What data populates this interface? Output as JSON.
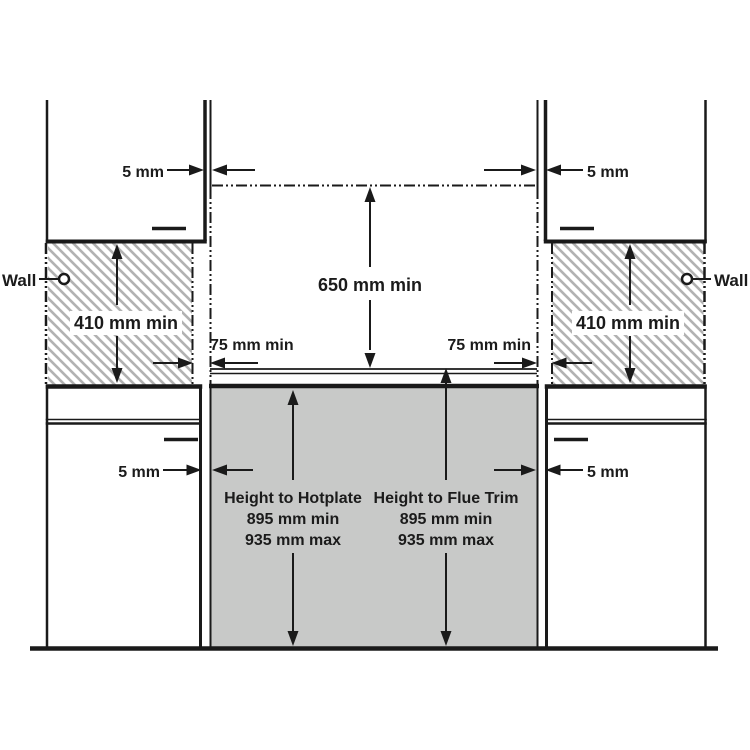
{
  "labels": {
    "wall_left": "Wall",
    "wall_right": "Wall",
    "gap_top_left": "5 mm",
    "gap_top_right": "5 mm",
    "gap_bottom_left": "5 mm",
    "gap_bottom_right": "5 mm",
    "clearance_center_vertical": "650 mm min",
    "clearance_wall_left": "410 mm min",
    "clearance_wall_right": "410 mm min",
    "clearance_hob_left": "75 mm min",
    "clearance_hob_right": "75 mm min",
    "height_to_hotplate": {
      "title": "Height to Hotplate",
      "min": "895 mm min",
      "max": "935 mm max"
    },
    "height_to_flue_trim": {
      "title": "Height to Flue Trim",
      "min": "895 mm min",
      "max": "935 mm max"
    }
  },
  "colors": {
    "line": "#1a1a1a",
    "cooker_fill": "#c8c9c8",
    "hatch_stroke": "#b2b2b2",
    "background": "#ffffff"
  }
}
